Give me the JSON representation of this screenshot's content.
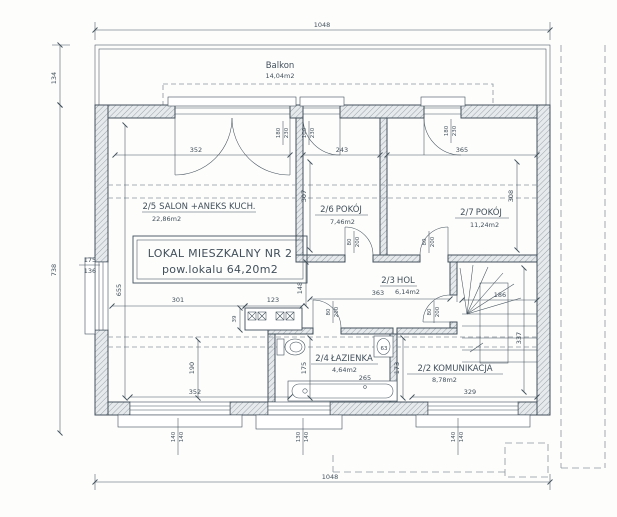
{
  "plan": {
    "balcony": {
      "label": "Balkon",
      "area": "14,04m2"
    },
    "unit_box": {
      "line1": "LOKAL MIESZKALNY NR 2",
      "line2": "pow.lokalu 64,20m2"
    },
    "rooms": {
      "salon": {
        "id": "2/5",
        "name": "SALON +ANEKS KUCH.",
        "area": "22,86m2"
      },
      "pokoj_26": {
        "id": "2/6",
        "name": "POKÓJ",
        "area": "7,46m2"
      },
      "pokoj_27": {
        "id": "2/7",
        "name": "POKÓJ",
        "area": "11,24m2"
      },
      "hol": {
        "id": "2/3",
        "name": "HOL",
        "area": "6,14m2"
      },
      "lazienka": {
        "id": "2/4",
        "name": "ŁAZIENKA",
        "area": "4,64m2"
      },
      "komunikacja": {
        "id": "2/2",
        "name": "KOMUNIKACJA",
        "area": "8,78m2"
      }
    },
    "dims": {
      "top_total": "1048",
      "bottom_total": "1048",
      "balcony_depth": "134",
      "left_height": "738",
      "salon_opening": "352",
      "pokoj26_width": "243",
      "pokoj27_width": "365",
      "pokoj26_depth": "307",
      "pokoj27_depth": "308",
      "salon_depth": "655",
      "salon_lower": "190",
      "salon_bottom": "301",
      "counter_width": "123",
      "passage_width": "148",
      "counter_depth": "39",
      "hol_width": "363",
      "stair_width": "186",
      "stair_run": "337",
      "bath_left": "175",
      "bath_right": "173",
      "tub_length": "265",
      "sink_width": "63",
      "bottom_window_left": "352",
      "komunikacja_width": "329"
    },
    "openings": {
      "salon_balcony_door": {
        "w": "180",
        "h": "230"
      },
      "pokoj26_balcony_door": {
        "w": "100",
        "h": "230"
      },
      "pokoj27_balcony_door": {
        "w": "180",
        "h": "230"
      },
      "pokoj26_door": {
        "w": "80",
        "h": "200"
      },
      "pokoj27_door": {
        "w": "80",
        "h": "200"
      },
      "lazienka_door": {
        "w": "80",
        "h": "200"
      },
      "komunikacja_door": {
        "w": "80",
        "h": "200"
      },
      "left_window": {
        "w": "175",
        "h": "136"
      },
      "bottom_window_1": {
        "w": "140",
        "h": "140"
      },
      "bottom_window_2": {
        "w": "130",
        "h": "140"
      },
      "bottom_window_3": {
        "w": "140",
        "h": "140"
      }
    },
    "colors": {
      "ink": "#42505b",
      "ink_light": "#8a949c",
      "paper": "#fdfdfc",
      "wall_fill": "#e7eaec"
    }
  }
}
